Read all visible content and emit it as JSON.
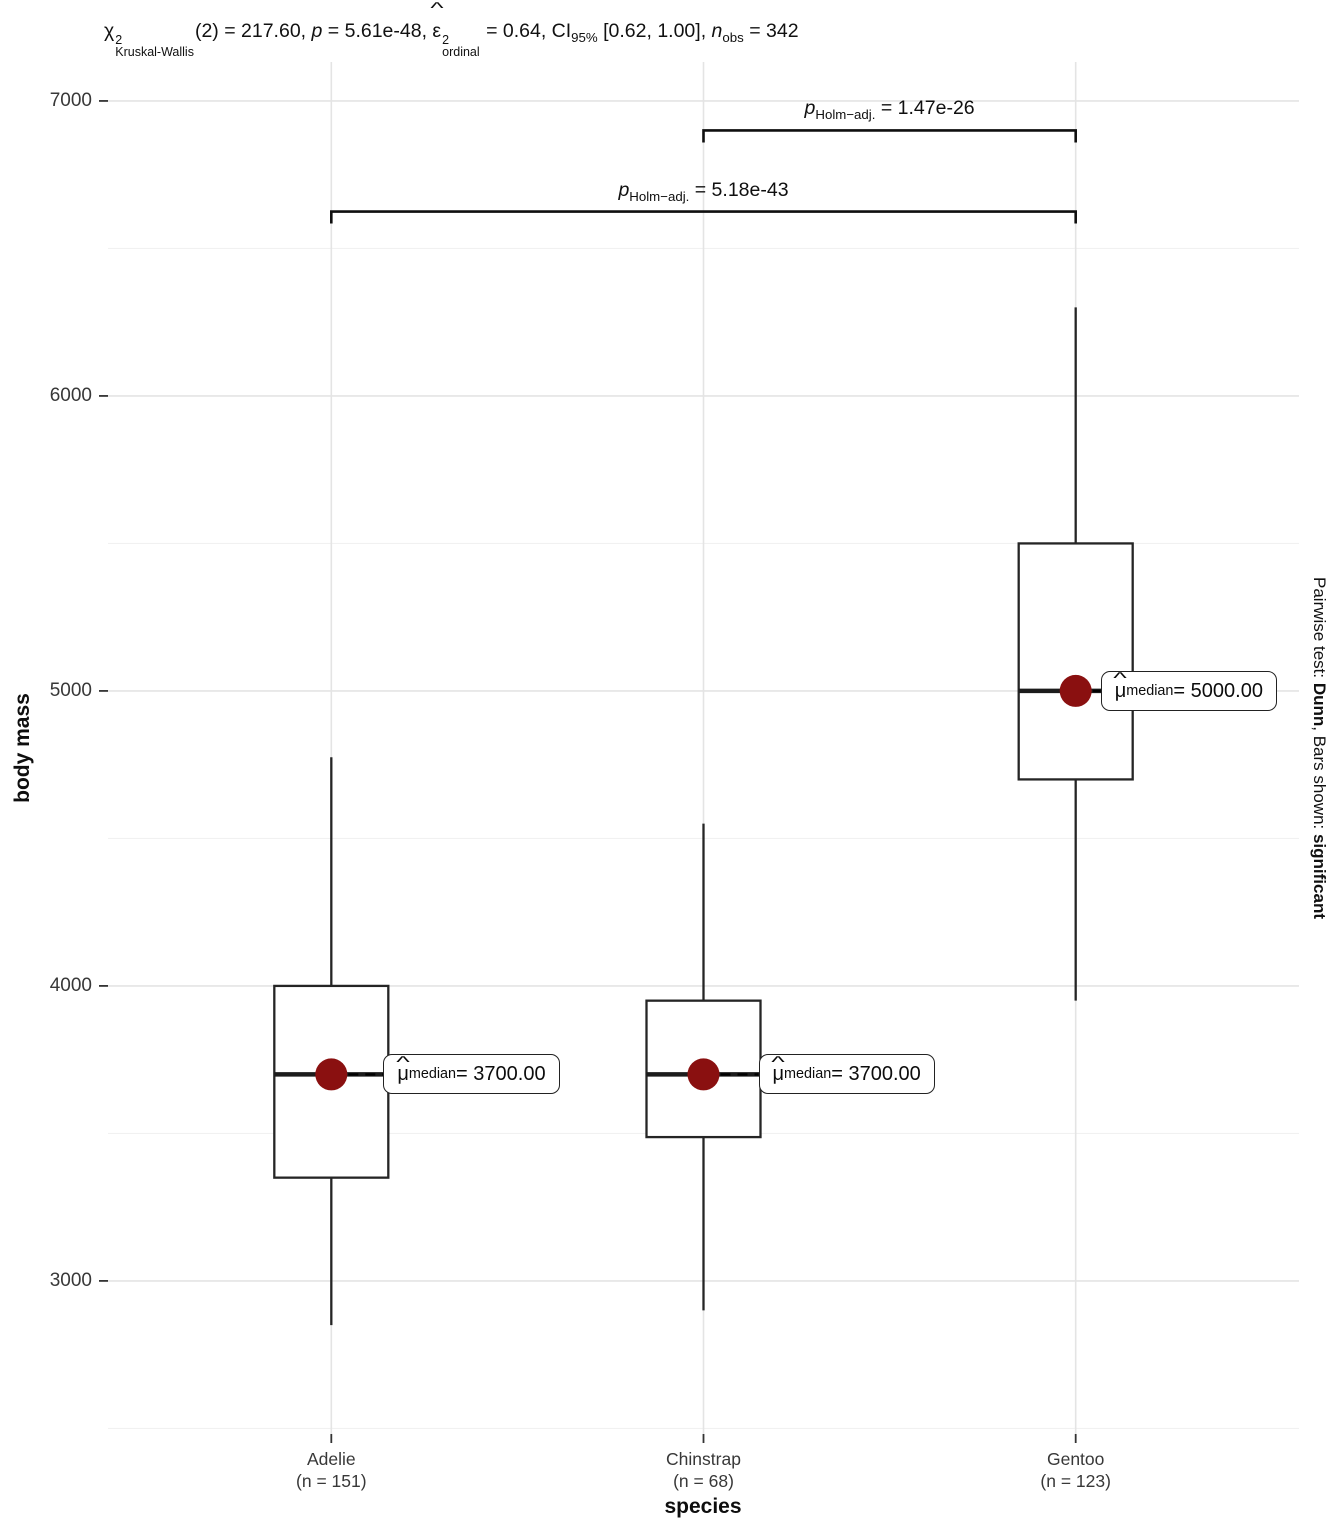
{
  "title": {
    "segments": [
      {
        "t": "bstack",
        "base": "χ",
        "hat": false,
        "sup": "2",
        "sub": "Kruskal-Wallis"
      },
      {
        "t": "text",
        "v": "(2) = 217.60, "
      },
      {
        "t": "italic",
        "v": "p"
      },
      {
        "t": "text",
        "v": " = 5.61e-48, "
      },
      {
        "t": "bstack",
        "base": "ε",
        "hat": true,
        "sup": "2",
        "sub": "ordinal"
      },
      {
        "t": "text",
        "v": " = 0.64, CI"
      },
      {
        "t": "sub",
        "v": "95%"
      },
      {
        "t": "text",
        "v": " [0.62, 1.00], "
      },
      {
        "t": "italic",
        "v": "n"
      },
      {
        "t": "sub",
        "v": "obs"
      },
      {
        "t": "text",
        "v": " = 342"
      }
    ]
  },
  "chart_data": {
    "type": "boxplot",
    "title": "Kruskal-Wallis chi-squared(2) = 217.60, p = 5.61e-48, epsilon-squared ordinal = 0.64, CI 95% [0.62, 1.00], n obs = 342",
    "xlabel": "species",
    "ylabel": "body mass",
    "y_ticks": [
      3000,
      4000,
      5000,
      6000,
      7000
    ],
    "y_minor_gridlines": [
      2500,
      3500,
      4500,
      5500,
      6500
    ],
    "ylim": [
      2481,
      7132
    ],
    "grid": true,
    "legend": "none",
    "groups": [
      {
        "name": "Adelie",
        "n": 151,
        "tick_label_line1": "Adelie",
        "tick_label_line2": "(n = 151)",
        "whisker_low": 2850,
        "q1": 3350,
        "median": 3700,
        "q3": 4000,
        "whisker_high": 4775,
        "median_point": 3700,
        "median_label": {
          "symbol": "μ",
          "hat": "^",
          "sub": "median",
          "eq": " = ",
          "value": "3700.00"
        }
      },
      {
        "name": "Chinstrap",
        "n": 68,
        "tick_label_line1": "Chinstrap",
        "tick_label_line2": "(n = 68)",
        "whisker_low": 2900,
        "q1": 3487.5,
        "median": 3700,
        "q3": 3950,
        "whisker_high": 4550,
        "median_point": 3700,
        "median_label": {
          "symbol": "μ",
          "hat": "^",
          "sub": "median",
          "eq": " = ",
          "value": "3700.00"
        }
      },
      {
        "name": "Gentoo",
        "n": 123,
        "tick_label_line1": "Gentoo",
        "tick_label_line2": "(n = 123)",
        "whisker_low": 3950,
        "q1": 4700,
        "median": 5000,
        "q3": 5500,
        "whisker_high": 6300,
        "median_point": 5000,
        "median_label": {
          "symbol": "μ",
          "hat": "^",
          "sub": "median",
          "eq": " = ",
          "value": "5000.00"
        }
      }
    ],
    "comparisons": [
      {
        "from": "Adelie",
        "to": "Gentoo",
        "bar_y": 6625,
        "label": {
          "p": "p",
          "sub": "Holm−adj.",
          "eq": " = ",
          "value": "5.18e-43"
        }
      },
      {
        "from": "Chinstrap",
        "to": "Gentoo",
        "bar_y": 6900,
        "label": {
          "p": "p",
          "sub": "Holm−adj.",
          "eq": " = ",
          "value": "1.47e-26"
        }
      }
    ],
    "caption_right": {
      "segments": [
        {
          "v": "Pairwise test: "
        },
        {
          "v": "Dunn",
          "bold": true
        },
        {
          "v": ", Bars shown: "
        },
        {
          "v": "significant",
          "bold": true
        }
      ]
    },
    "colors": {
      "median_dot": "#8A1010",
      "box_stroke": "#252525",
      "median_line": "#1c1c1c",
      "bracket": "#0f0f0f",
      "grid_major": "#E4E4E4",
      "grid_minor": "#F1F1F1",
      "tick": "#333333",
      "background": "#FFFFFF"
    }
  }
}
